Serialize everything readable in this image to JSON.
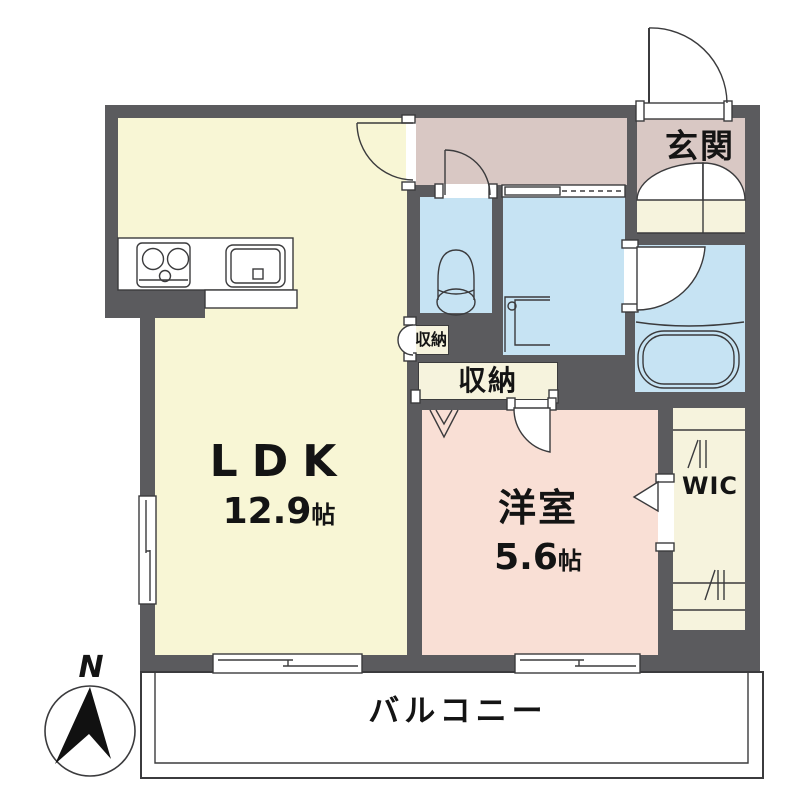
{
  "plan_title": "1LDK apartment floor plan",
  "rooms": {
    "ldk": {
      "label": "LDK",
      "size_value": "12.9",
      "size_unit": "帖"
    },
    "western_room": {
      "label": "洋室",
      "size_value": "5.6",
      "size_unit": "帖"
    },
    "entrance": {
      "label": "玄関"
    },
    "storage_small": {
      "label": "収納"
    },
    "storage_large": {
      "label": "収納"
    },
    "wic": {
      "label": "WIC"
    },
    "balcony": {
      "label": "バルコニー"
    }
  },
  "compass": {
    "north_label": "N"
  },
  "colors": {
    "wall": "#5b5b5e",
    "ldk_fill": "#f8f6d5",
    "corridor_entrance_fill": "#d9c8c4",
    "wet_area_fill": "#c6e3f3",
    "western_room_fill": "#f9dfd5",
    "storage_fill": "#f6f3dd",
    "line": "#3b3b3d",
    "text": "#141414"
  }
}
